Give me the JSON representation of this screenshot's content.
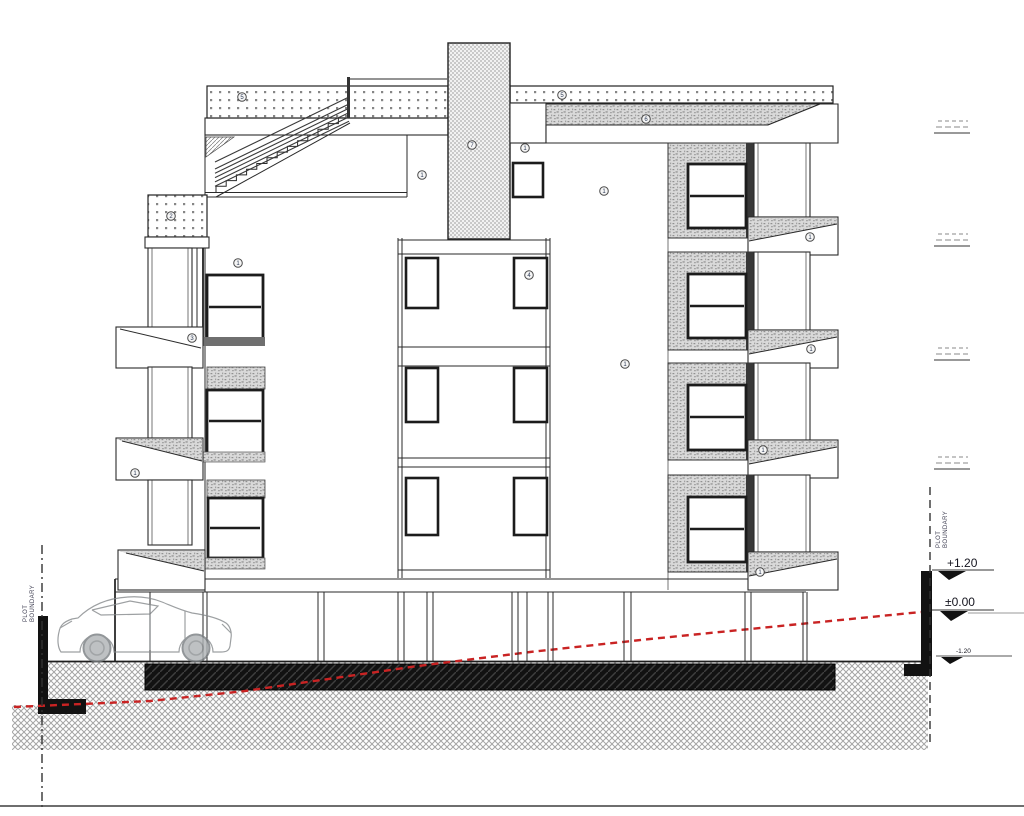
{
  "drawing": {
    "type": "architectural-section-elevation",
    "levels": {
      "plus": "+1.20",
      "zero": "±0.00",
      "minus": "-1.20"
    },
    "boundaries": {
      "left": {
        "line1": "PLOT",
        "line2": "BOUNDARY"
      },
      "right": {
        "line1": "PLOT",
        "line2": "BOUNDARY"
      }
    },
    "colors": {
      "linework": "#2a2a2a",
      "existing_ground_red": "#c92323",
      "foundation_black": "#121212",
      "hatch_gray": "#a5a5a5"
    },
    "keynotes": [
      {
        "x": 242,
        "y": 97,
        "label": "5"
      },
      {
        "x": 562,
        "y": 95,
        "label": "5"
      },
      {
        "x": 472,
        "y": 145,
        "label": "7"
      },
      {
        "x": 525,
        "y": 148,
        "label": "1"
      },
      {
        "x": 422,
        "y": 175,
        "label": "1"
      },
      {
        "x": 646,
        "y": 119,
        "label": "6"
      },
      {
        "x": 604,
        "y": 191,
        "label": "1"
      },
      {
        "x": 171,
        "y": 216,
        "label": "2"
      },
      {
        "x": 238,
        "y": 263,
        "label": "1"
      },
      {
        "x": 529,
        "y": 275,
        "label": "4"
      },
      {
        "x": 192,
        "y": 338,
        "label": "3"
      },
      {
        "x": 810,
        "y": 237,
        "label": "1"
      },
      {
        "x": 625,
        "y": 364,
        "label": "1"
      },
      {
        "x": 811,
        "y": 349,
        "label": "1"
      },
      {
        "x": 135,
        "y": 473,
        "label": "1"
      },
      {
        "x": 763,
        "y": 450,
        "label": "1"
      },
      {
        "x": 760,
        "y": 572,
        "label": "1"
      }
    ]
  }
}
